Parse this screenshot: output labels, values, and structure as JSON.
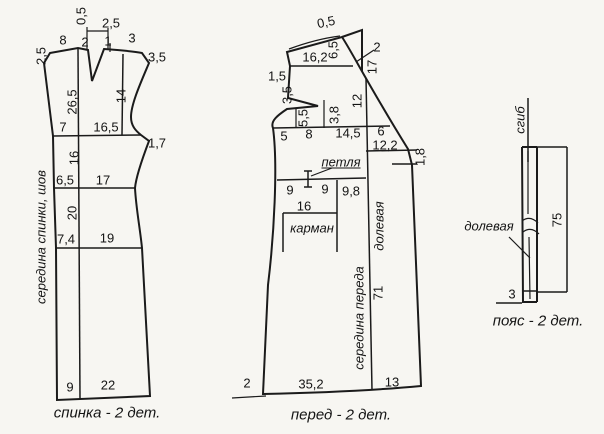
{
  "figure": {
    "type": "sewing-pattern-drafting-diagram",
    "background": "#f7f6f2",
    "line_color": "#1b1b1b",
    "pieces_count": 3
  },
  "pieces": {
    "back": {
      "caption": "спинка - 2 дет.",
      "labels": [
        {
          "t": "0,5",
          "x": 81,
          "y": 16,
          "rot": -90
        },
        {
          "t": "2,5",
          "x": 111,
          "y": 23
        },
        {
          "t": "8",
          "x": 63,
          "y": 40
        },
        {
          "t": "2",
          "x": 85,
          "y": 42
        },
        {
          "t": "1",
          "x": 108,
          "y": 41
        },
        {
          "t": "3",
          "x": 132,
          "y": 38
        },
        {
          "t": "2,5",
          "x": 41,
          "y": 56,
          "rot": -90
        },
        {
          "t": "3,5",
          "x": 157,
          "y": 57
        },
        {
          "t": "26,5",
          "x": 72,
          "y": 102,
          "rot": -90
        },
        {
          "t": "14",
          "x": 121,
          "y": 96,
          "rot": -90
        },
        {
          "t": "7",
          "x": 63,
          "y": 127
        },
        {
          "t": "16,5",
          "x": 106,
          "y": 127
        },
        {
          "t": "1,7",
          "x": 157,
          "y": 143
        },
        {
          "t": "16",
          "x": 74,
          "y": 158,
          "rot": -90
        },
        {
          "t": "6,5",
          "x": 65,
          "y": 180
        },
        {
          "t": "17",
          "x": 103,
          "y": 180
        },
        {
          "t": "20",
          "x": 72,
          "y": 213,
          "rot": -90
        },
        {
          "t": "7,4",
          "x": 66,
          "y": 239
        },
        {
          "t": "19",
          "x": 107,
          "y": 238
        },
        {
          "t": "9",
          "x": 70,
          "y": 387
        },
        {
          "t": "22",
          "x": 108,
          "y": 385
        },
        {
          "t": "середина спинки, шов",
          "x": 41,
          "y": 237,
          "rot": -90,
          "cls": "ital",
          "name": "back-center-seam-label"
        }
      ]
    },
    "front": {
      "caption": "перед - 2 дет.",
      "labels": [
        {
          "t": "0,5",
          "x": 326,
          "y": 22,
          "rot": -12
        },
        {
          "t": "16,2",
          "x": 315,
          "y": 57
        },
        {
          "t": "6,5",
          "x": 333,
          "y": 50,
          "rot": -90
        },
        {
          "t": "2",
          "x": 377,
          "y": 47
        },
        {
          "t": "17",
          "x": 372,
          "y": 67,
          "rot": -90
        },
        {
          "t": "1,5",
          "x": 277,
          "y": 76
        },
        {
          "t": "3,5",
          "x": 287,
          "y": 95,
          "rot": -90
        },
        {
          "t": "5,5",
          "x": 303,
          "y": 118,
          "rot": -90
        },
        {
          "t": "3,8",
          "x": 334,
          "y": 115,
          "rot": -90
        },
        {
          "t": "12",
          "x": 357,
          "y": 101,
          "rot": -90
        },
        {
          "t": "5",
          "x": 284,
          "y": 136
        },
        {
          "t": "8",
          "x": 309,
          "y": 134
        },
        {
          "t": "14,5",
          "x": 348,
          "y": 133
        },
        {
          "t": "6",
          "x": 381,
          "y": 131
        },
        {
          "t": "12,2",
          "x": 385,
          "y": 145
        },
        {
          "t": "1,8",
          "x": 420,
          "y": 157,
          "rot": -90
        },
        {
          "t": "петля",
          "x": 341,
          "y": 162,
          "cls": "ital und",
          "name": "buttonhole-label"
        },
        {
          "t": "9",
          "x": 290,
          "y": 190
        },
        {
          "t": "9",
          "x": 325,
          "y": 189
        },
        {
          "t": "9,8",
          "x": 351,
          "y": 191
        },
        {
          "t": "16",
          "x": 304,
          "y": 206
        },
        {
          "t": "карман",
          "x": 312,
          "y": 228,
          "cls": "ital",
          "name": "pocket-label"
        },
        {
          "t": "долевая",
          "x": 379,
          "y": 226,
          "rot": -90,
          "cls": "ital",
          "name": "front-grainline-label"
        },
        {
          "t": "71",
          "x": 378,
          "y": 293,
          "rot": -90
        },
        {
          "t": "середина переда",
          "x": 359,
          "y": 318,
          "rot": -90,
          "cls": "ital",
          "name": "front-center-label"
        },
        {
          "t": "2",
          "x": 247,
          "y": 383
        },
        {
          "t": "35,2",
          "x": 311,
          "y": 384
        },
        {
          "t": "13",
          "x": 392,
          "y": 382
        }
      ]
    },
    "belt": {
      "caption": "пояс - 2 дет.",
      "labels": [
        {
          "t": "сгиб",
          "x": 520,
          "y": 120,
          "rot": -90,
          "cls": "ital",
          "name": "fold-label"
        },
        {
          "t": "долевая",
          "x": 489,
          "y": 226,
          "cls": "ital",
          "name": "belt-grainline-label"
        },
        {
          "t": "75",
          "x": 557,
          "y": 220,
          "rot": -90
        },
        {
          "t": "3",
          "x": 512,
          "y": 294
        }
      ]
    }
  }
}
